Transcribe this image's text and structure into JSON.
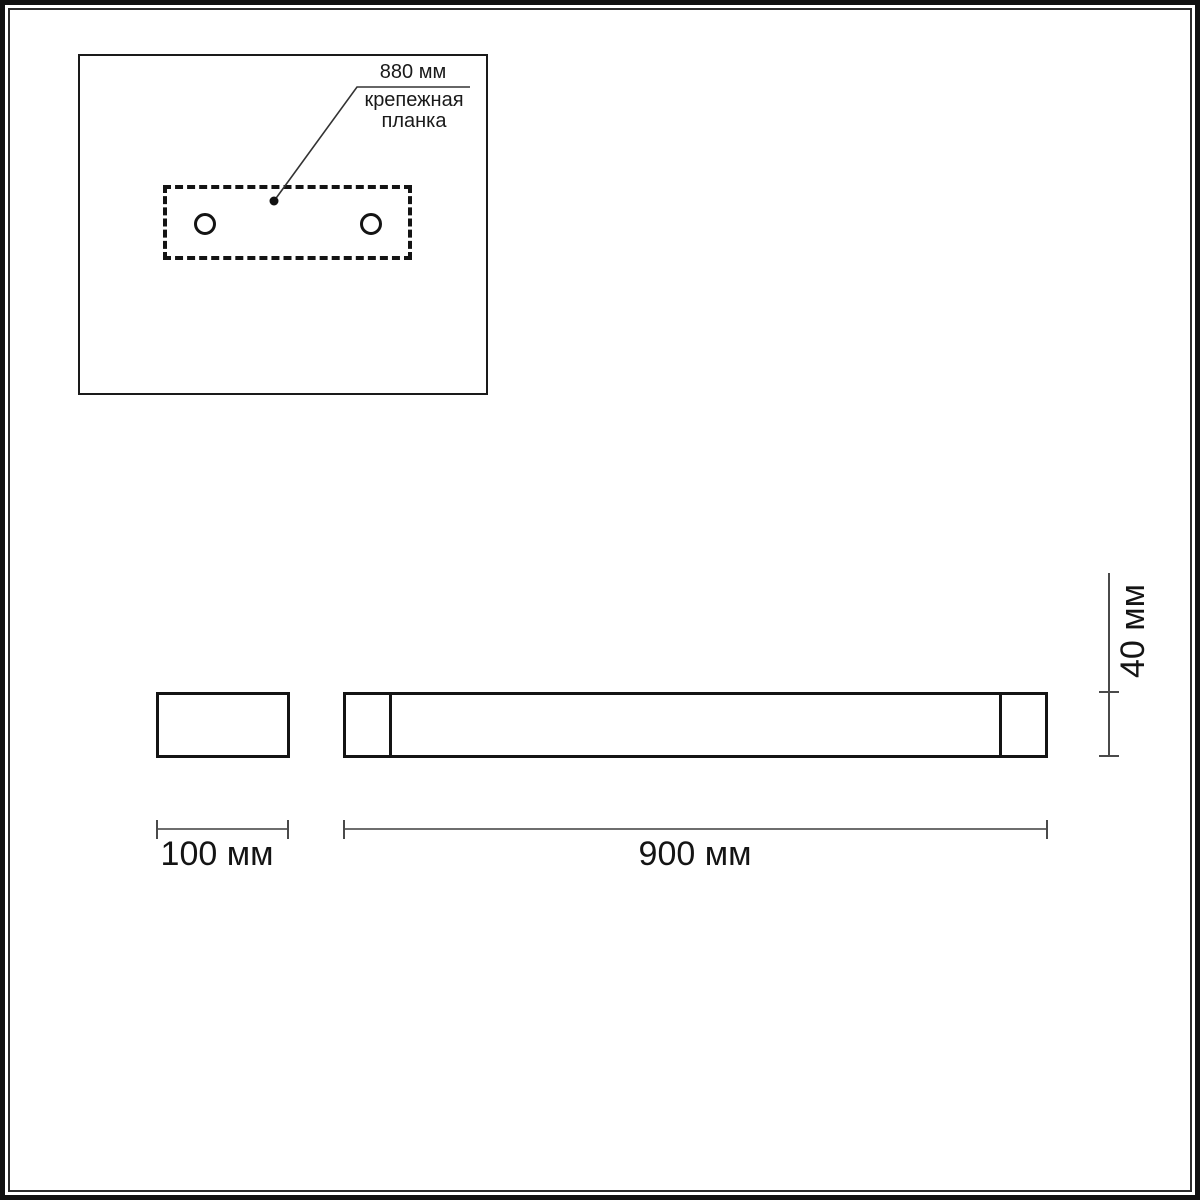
{
  "page": {
    "background": "#ffffff",
    "ink_color": "#1a1a1a",
    "dim_line_color": "#6e6e6e"
  },
  "detail_view": {
    "dimension_label": "880 мм",
    "part_label": "крепежная\nпланка"
  },
  "dimensions": {
    "side_width": "100 мм",
    "front_width": "900 мм",
    "height": "40 мм"
  }
}
